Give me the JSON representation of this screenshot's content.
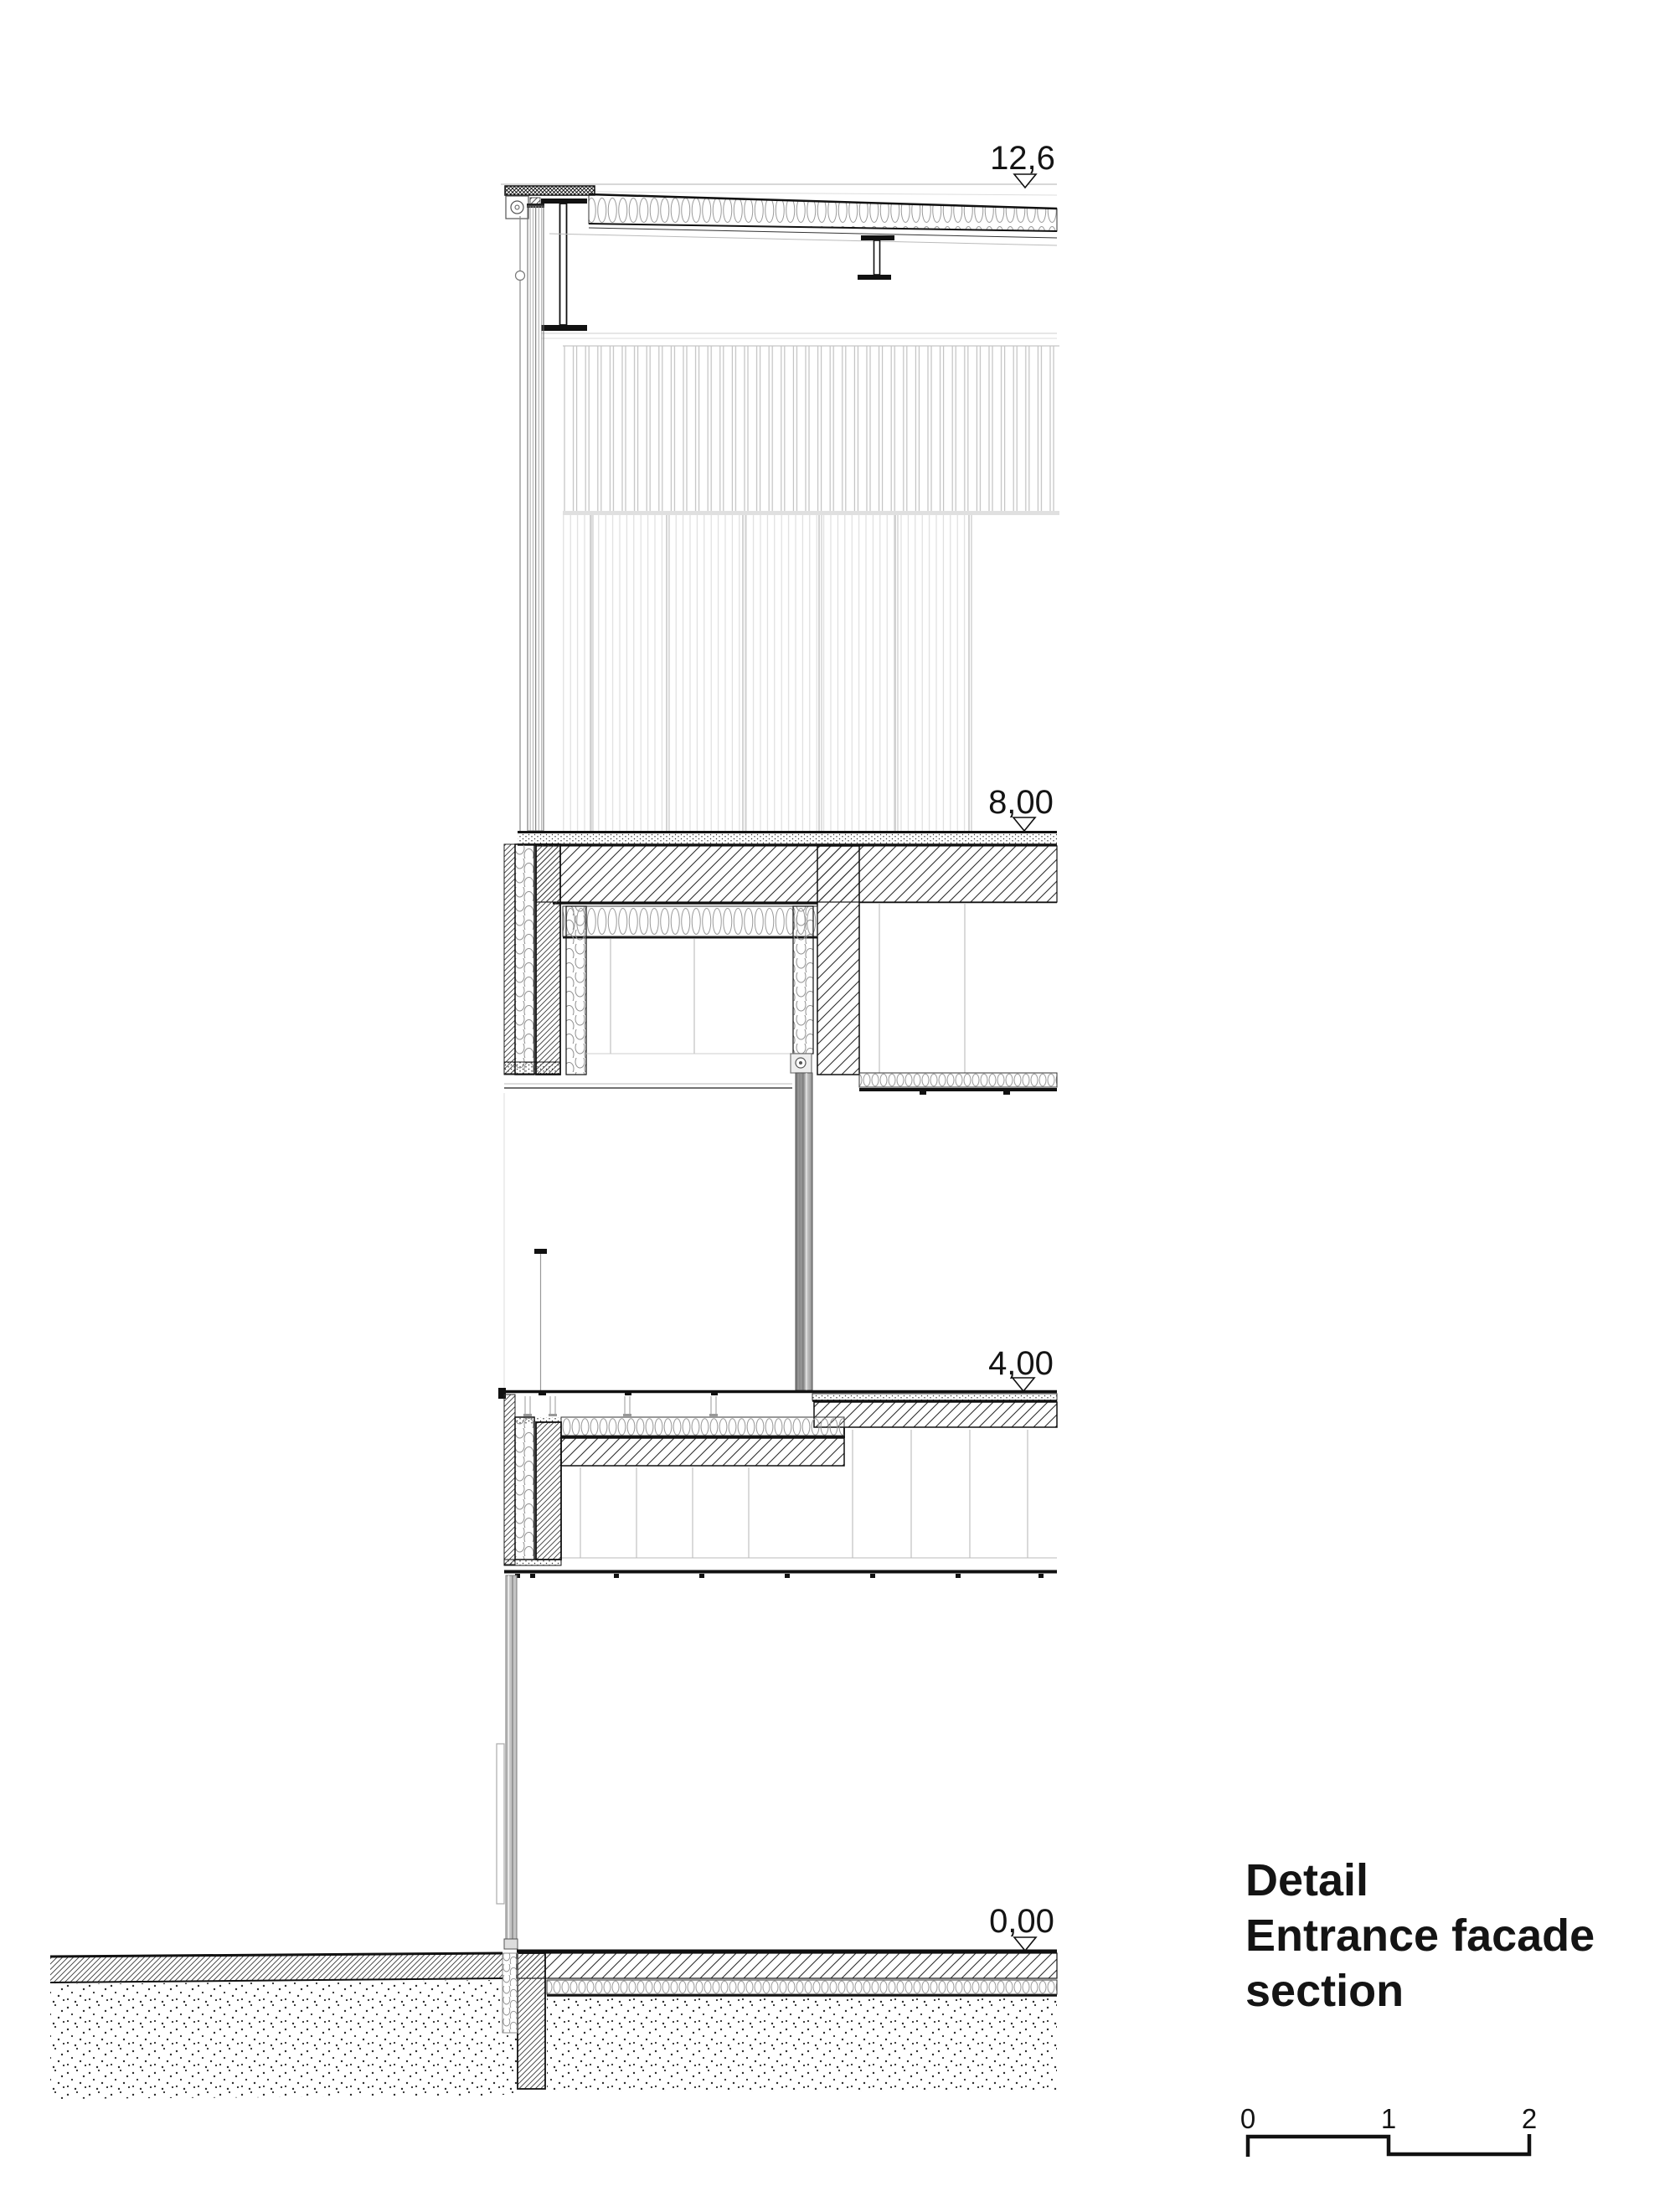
{
  "page": {
    "background": "#ffffff"
  },
  "drawing": {
    "kind": "architectural facade section detail",
    "levels": [
      {
        "id": "roof-level",
        "label": "12,6"
      },
      {
        "id": "floor-8-level",
        "label": "8,00"
      },
      {
        "id": "floor-4-level",
        "label": "4,00"
      },
      {
        "id": "ground-level",
        "label": "0,00"
      }
    ],
    "title": {
      "line1": "Detail",
      "line2": "Entrance facade",
      "line3": "section"
    },
    "scale_bar": {
      "tick0": "0",
      "tick1": "1",
      "tick2": "2"
    }
  },
  "colors": {
    "ink": "#141414",
    "hatch": "#2e2e2e",
    "faint_line": "#c8c8c8",
    "insulation": "#9a9a9a",
    "cladding_panel": "#c2c2c2",
    "cladding_fine": "#d8d8d8",
    "mullion_gray": "#8a8a8a",
    "background": "#ffffff"
  }
}
